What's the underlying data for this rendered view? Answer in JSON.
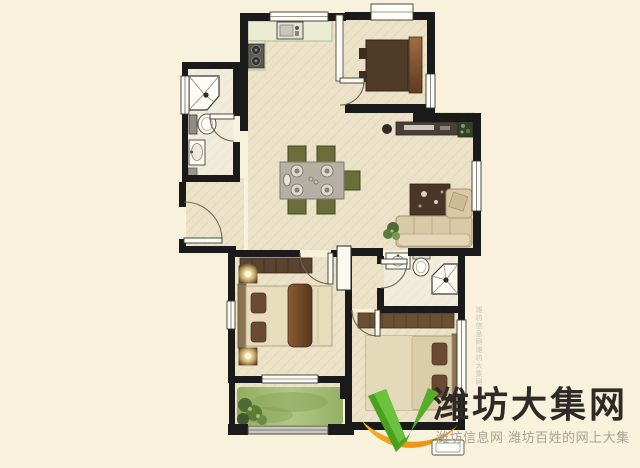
{
  "watermark": {
    "brand": "潍坊大集网",
    "tagline": "潍坊信息网 潍坊百姓的网上大集",
    "vertical_text": "潍坊信息网潍坊大集网",
    "logo_name": "green-v-with-orange-swoosh"
  },
  "palette": {
    "background": "#f8f1dc",
    "floor": "#ece2c8",
    "bath_floor": "#f2ecdc",
    "wall": "#1a1a1a",
    "window": "#fdfcf5",
    "counter": "#eaecd3",
    "grass": "#9db86a",
    "wood_dark": "#4f3b28",
    "bed_light": "#e7dcbc",
    "quilt_brown": "#6b4a2e",
    "sofa_beige": "#d9c9a6",
    "rug_brown": "#4a3526",
    "chair_olive": "#6a6f3a",
    "logo_green": "#55a82d",
    "logo_orange": "#f0971c",
    "brand_text": "#2f2a26",
    "tagline_text": "#a8a396"
  },
  "floor_plan": {
    "type": "residential-apartment-top-view",
    "rooms": [
      "kitchen",
      "bathroom-top-left",
      "entry-hall",
      "dining-area",
      "bedroom-top-right",
      "living-room",
      "master-bedroom",
      "balcony",
      "bathroom-bottom-right",
      "bedroom-bottom-right"
    ],
    "fixtures": [
      "kitchen-sink",
      "two-burner-stove",
      "corner-shower",
      "toilet",
      "washbasin",
      "dining-table-with-chairs",
      "tv-console",
      "l-shaped-sofa",
      "area-rug",
      "double-bed",
      "nightstand-lamps",
      "wardrobe",
      "potted-plants",
      "lawn-strip",
      "doors-with-swing-arcs",
      "windows"
    ]
  }
}
